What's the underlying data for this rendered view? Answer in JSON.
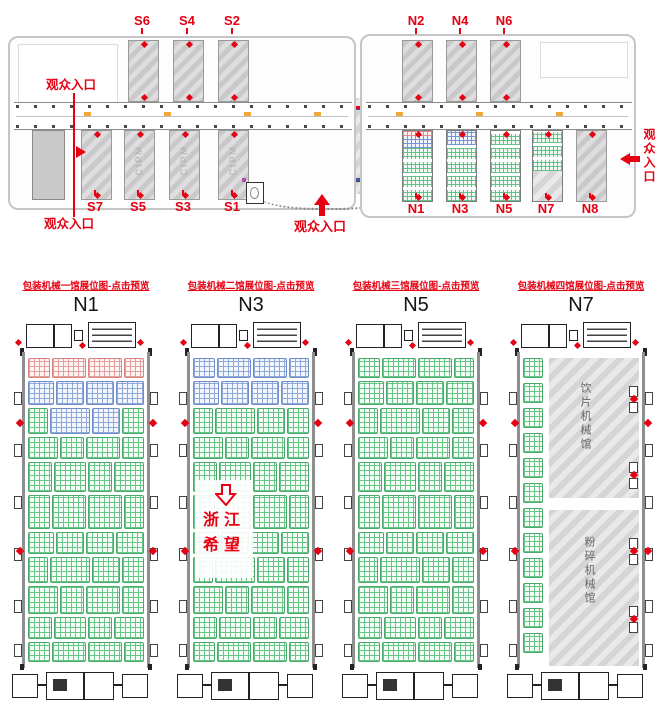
{
  "overview": {
    "entrance_label": "观众入口",
    "center_building": {
      "label": "C",
      "watermark": "CIPM"
    },
    "watermark": "CIPM",
    "south_halls_top": [
      "S6",
      "S4",
      "S2"
    ],
    "south_halls_bottom": [
      "S7",
      "S5",
      "S3",
      "S1"
    ],
    "north_halls_top": [
      "N2",
      "N4",
      "N6"
    ],
    "north_halls_bottom": [
      "N1",
      "N3",
      "N5",
      "N7",
      "N8"
    ],
    "colors": {
      "label_red": "#e60012",
      "hatch_dark": "#c9c9c9",
      "hatch_light": "#dedede"
    }
  },
  "halls": [
    {
      "id": "N1",
      "title": "N1",
      "link_label": "包装机械一馆展位图-点击预览",
      "row_scheme": [
        "pink",
        "blue",
        "mixed",
        "green",
        "green",
        "green",
        "green",
        "green",
        "green",
        "green",
        "green"
      ]
    },
    {
      "id": "N3",
      "title": "N3",
      "link_label": "包装机械二馆展位图-点击预览",
      "row_scheme": [
        "blue",
        "blue",
        "green",
        "green",
        "green",
        "green",
        "green",
        "green",
        "green",
        "green",
        "green"
      ],
      "annotation": {
        "arrow": "down-hollow",
        "lines": [
          "浙江",
          "希望"
        ]
      }
    },
    {
      "id": "N5",
      "title": "N5",
      "link_label": "包装机械三馆展位图-点击预览",
      "row_scheme": [
        "green",
        "green",
        "green",
        "green",
        "green",
        "green",
        "green",
        "green",
        "green",
        "green",
        "green"
      ]
    },
    {
      "id": "N7",
      "title": "N7",
      "link_label": "包装机械四馆展位图-点击预览",
      "zones": [
        {
          "label": "饮片机械馆"
        },
        {
          "label": "粉碎机械馆"
        }
      ]
    }
  ],
  "booth_colors": {
    "green": {
      "line": "#69c58a",
      "border": "#49a96b",
      "tint": "#f4fcf6"
    },
    "blue": {
      "line": "#8fa9da",
      "border": "#6f8ec9",
      "tint": "#f3f7fd"
    },
    "pink": {
      "line": "#e4a0a0",
      "border": "#d98383",
      "tint": "#fdf4f4"
    }
  }
}
